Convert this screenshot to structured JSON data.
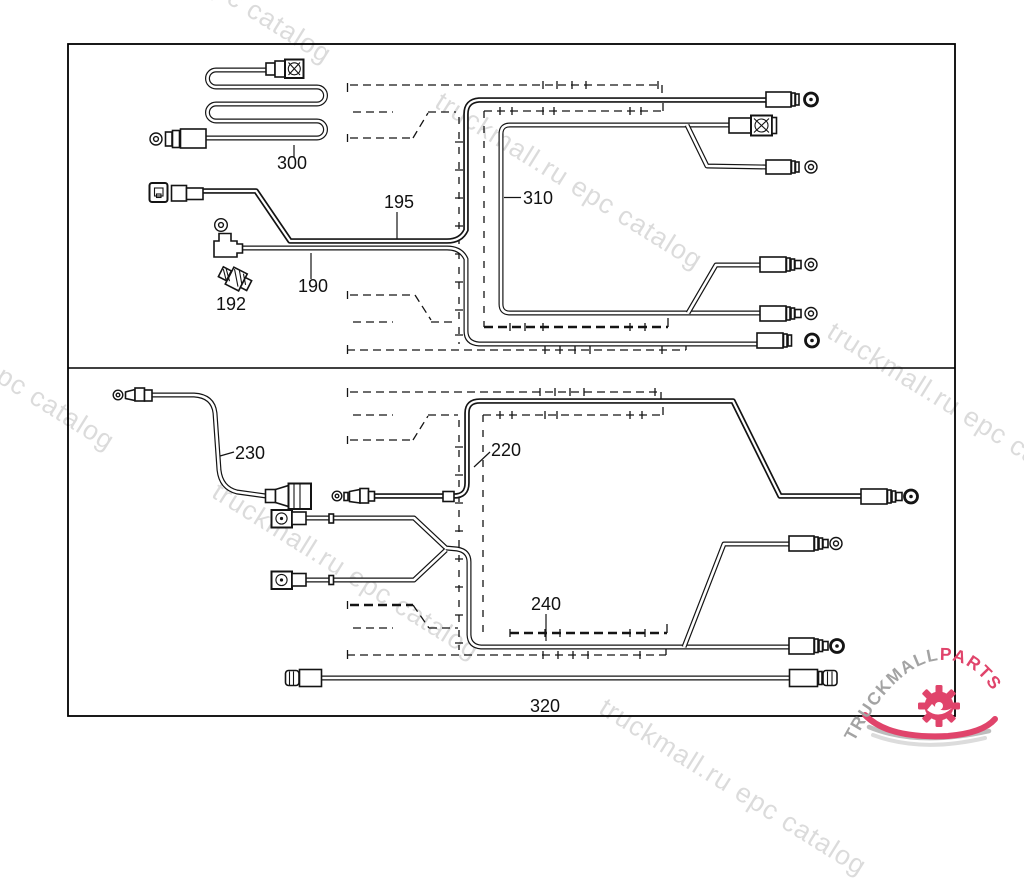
{
  "watermark": {
    "text": "truckmall.ru epc catalog"
  },
  "logo": {
    "brand": "TRUCKMALL",
    "suffix": "PARTS",
    "brand_color": "#a3a3a3",
    "accent_color": "#e0446b"
  },
  "diagram": {
    "type": "parts-diagram",
    "sections": [
      "upper-harness-group",
      "lower-harness-group"
    ],
    "parts": {
      "p300": "300",
      "p195": "195",
      "p310": "310",
      "p190": "190",
      "p192": "192",
      "p230": "230",
      "p220": "220",
      "p240": "240",
      "p320": "320"
    }
  },
  "colors": {
    "line_art": "#141414",
    "background": "#ffffff",
    "watermark_gray": "rgba(0,0,0,0.14)"
  }
}
